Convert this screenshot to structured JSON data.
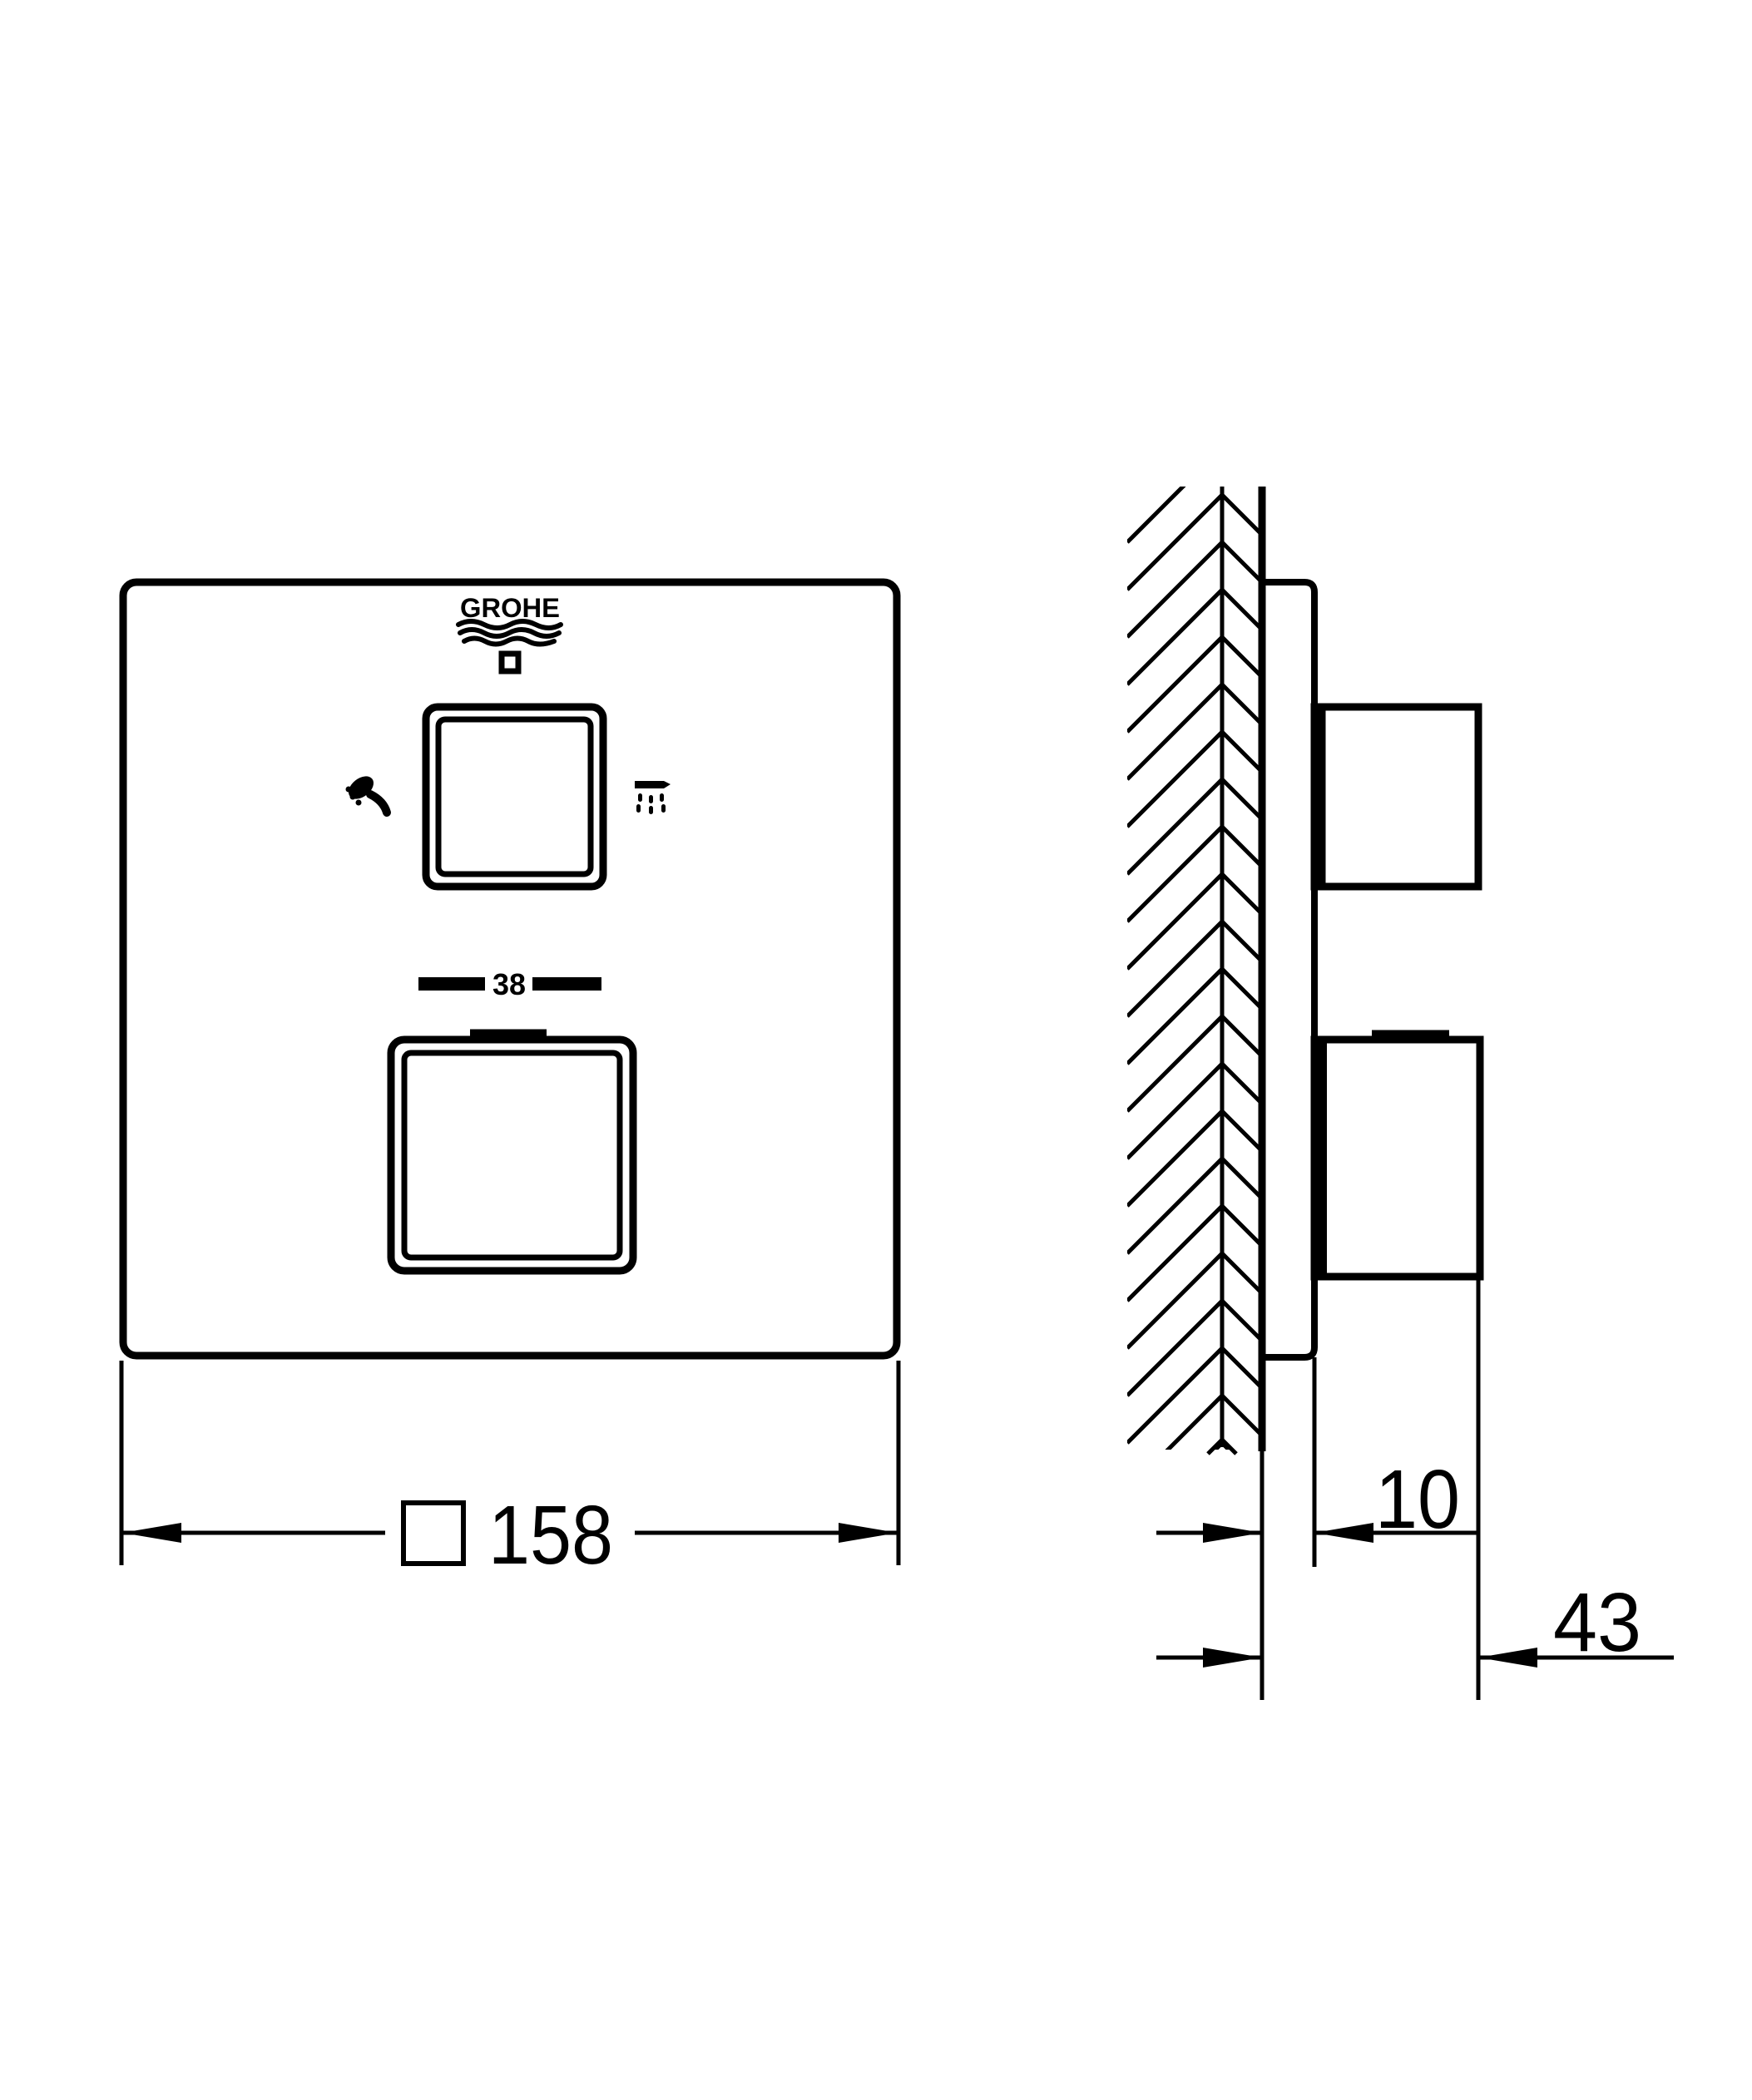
{
  "page": {
    "background": "#ffffff",
    "line_color": "#000000",
    "type_label": "technical dimension drawing"
  },
  "drawing": {
    "brand": "GROHE",
    "front_view": {
      "temperature_label": "38",
      "width_dimension": {
        "symbol": "square",
        "value": "158"
      },
      "icons": {
        "left_control": "hand-shower-icon",
        "right_control": "head-shower-icon",
        "below_logo": "eco-square-icon"
      }
    },
    "side_view": {
      "plate_depth_dimension": "10",
      "knob_projection_dimension": "43"
    }
  }
}
